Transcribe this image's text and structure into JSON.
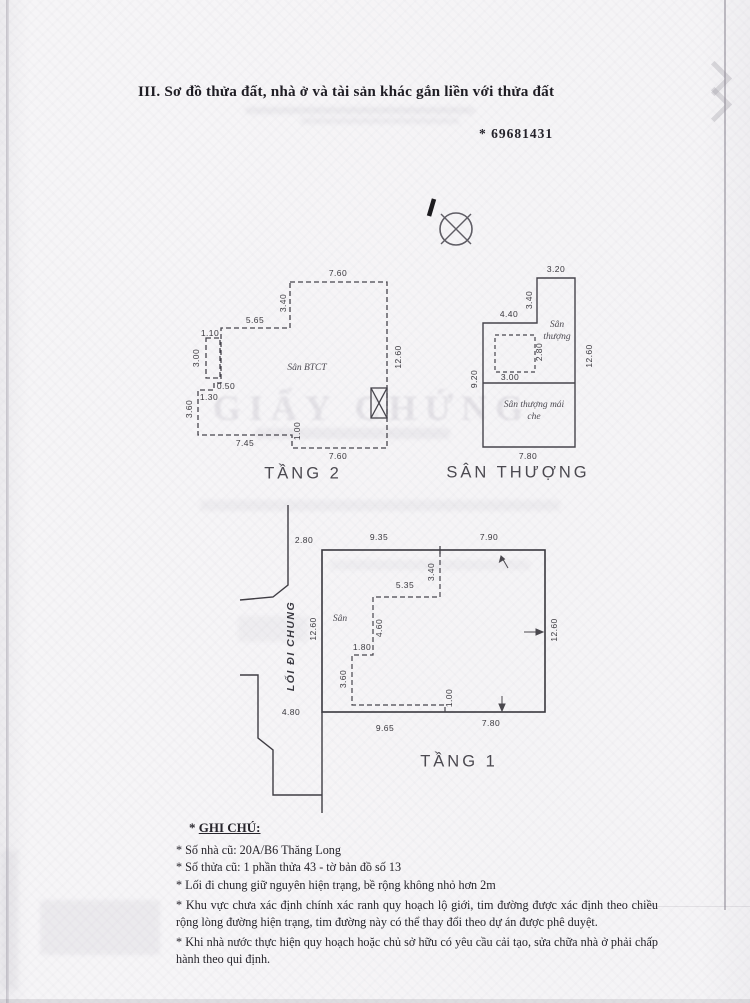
{
  "page": {
    "section_title": "III. Sơ đồ thửa đất, nhà ở và tài sản khác gắn liền với thửa đất",
    "serial": "* 69681431",
    "watermark_ghost": "GIẤY CHỨNG"
  },
  "plans": {
    "tang2": {
      "title": "TẦNG 2",
      "area_label": "Sân BTCT",
      "dims": {
        "top": "7.60",
        "left_upper": "3.40",
        "upper": "5.65",
        "closet_w": "1.10",
        "closet_h": "3.00",
        "step_a": "0.50",
        "step_b": "1.30",
        "left_lower": "3.60",
        "bottom_left": "7.45",
        "step_c": "1.00",
        "bottom_right": "7.60",
        "right": "12.60"
      }
    },
    "san_thuong": {
      "title": "SÂN THƯỢNG",
      "area_label_1": "Sân thượng",
      "area_label_2": "Sân thượng mái che",
      "dims": {
        "top": "3.20",
        "neck": "3.40",
        "upper": "4.40",
        "skylight_h": "2.80",
        "skylight_w": "3.00",
        "left": "9.20",
        "right": "12.60",
        "bottom": "7.80"
      }
    },
    "tang1": {
      "title": "TẦNG 1",
      "area_label": "Sân",
      "alley_label": "LỐI ĐI CHUNG",
      "dims": {
        "alley_top": "2.80",
        "top_left": "9.35",
        "top_right": "7.90",
        "inner_top": "5.35",
        "inner_right_v": "3.40",
        "inner_mid_v": "4.60",
        "inner_step": "1.80",
        "inner_left_v": "3.60",
        "inner_bottom_v": "1.00",
        "bottom_left": "9.65",
        "bottom_right": "7.80",
        "right": "12.60",
        "alley_mid": "12.60",
        "alley_bottom": "4.80"
      }
    }
  },
  "notes": {
    "star": "*",
    "heading": "GHI CHÚ:",
    "items": [
      "* Số nhà cũ: 20A/B6 Thăng Long",
      "* Số thửa cũ: 1 phần thửa 43 - tờ bản đồ số 13",
      "* Lối đi chung giữ nguyên hiện trạng, bề rộng không nhỏ hơn 2m",
      "* Khu vực chưa xác định chính xác ranh quy hoạch lộ giới, tim đường được xác định theo chiều rộng lòng đường hiện trạng, tim đường này có thể thay đổi theo dự án được phê duyệt.",
      "* Khi nhà nước thực hiện quy hoạch hoặc chủ sở hữu có yêu cầu cải tạo, sửa chữa nhà ở phải chấp hành theo qui định."
    ]
  }
}
